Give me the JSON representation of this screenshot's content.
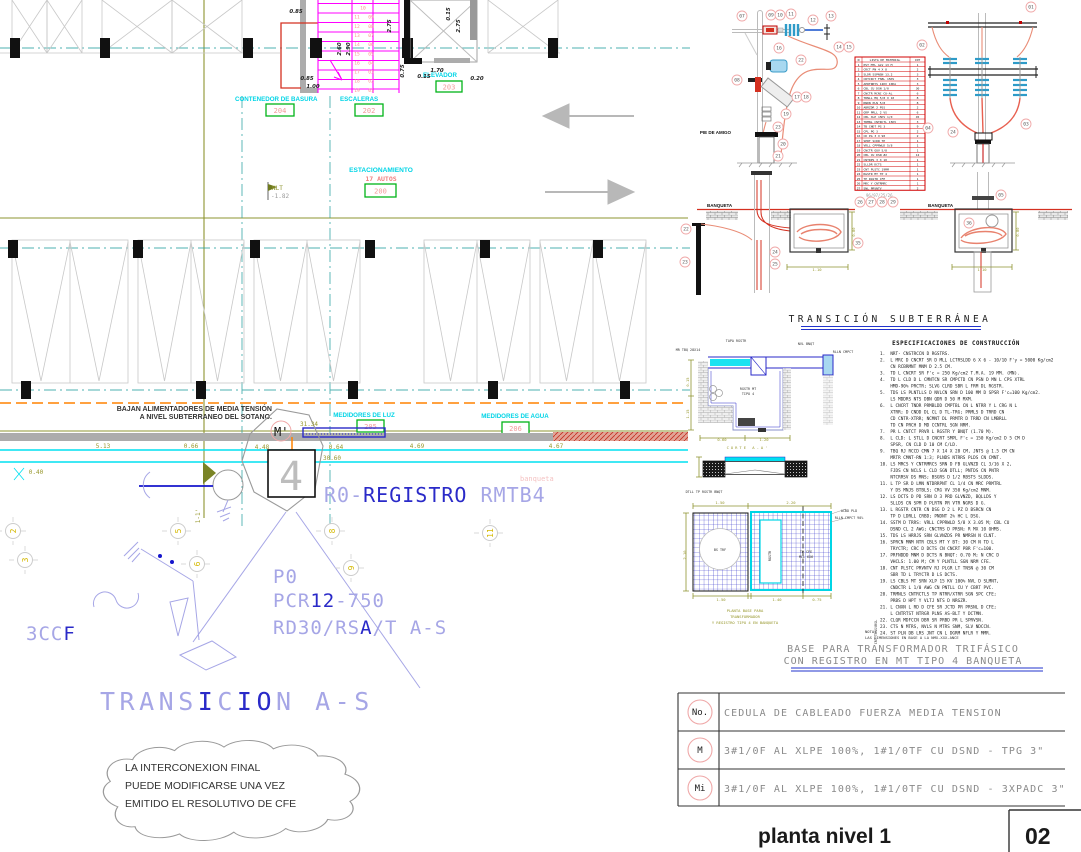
{
  "plan": {
    "labels": {
      "contenedor": "CONTENEDOR DE BASURA",
      "tag_contenedor": "204",
      "escaleras": "ESCALERAS",
      "tag_escaleras": "202",
      "elevador": "ELEVADOR",
      "tag_elevador": "203",
      "estacionamiento": "ESTACIONAMIENTO",
      "autos": "17 AUTOS",
      "tag_estacionamiento": "200",
      "medidores_luz": "MEDIDORES DE LUZ",
      "tag_luz": "205",
      "medidores_agua": "MEDIDORES DE AGUA",
      "tag_agua": "206",
      "nlt": "NLT",
      "nlt_level": "-1.82",
      "banqueta_faint": "banqueta"
    },
    "bajan_line1": "BAJAN ALIMENTADORES DE MEDIA TENSIÓN",
    "bajan_line2": "A NIVEL SUBTERRANEO DEL SOTANO.",
    "marker_m": "M'",
    "section_mark": "1-1'",
    "big_texts": {
      "p0": "P0",
      "reg_a": "R0-",
      "reg_b": "REGISTRO",
      "reg_c": " RMTB4",
      "pcr_a": "PCR",
      "pcr_b": "12",
      "pcr_c": "-750",
      "rd_a": "RD30/RS",
      "rd_b": "A",
      "rd_c": "/T A-S",
      "ccf_a": "3CC",
      "ccf_b": "F",
      "tr_a": "TRANS",
      "tr_b": "I",
      "tr_c": "C",
      "tr_d": "I",
      "tr_e": "O",
      "tr_f": "N A-S"
    },
    "cloud_lines": [
      "LA INTERCONEXION FINAL",
      "PUEDE MODIFICARSE UNA VEZ",
      "EMITIDO EL RESOLUTIVO DE CFE"
    ],
    "stair_steps_left": [
      "10",
      "11",
      "12",
      "13",
      "14",
      "15",
      "16",
      "17",
      "18",
      "19"
    ],
    "stair_steps_right": [
      "",
      "09",
      "08",
      "07",
      "06",
      "05",
      "04",
      "03",
      "02",
      "01"
    ],
    "grid_bubbles": [
      "2",
      "3",
      "5",
      "6",
      "8",
      "9",
      "11"
    ],
    "dims": [
      "0.85",
      "2.60",
      "2.90",
      "0.85",
      "1.00",
      "2.75",
      "2.75",
      "0.75",
      "0.15",
      "1.70",
      "0.20",
      "0.15",
      "5.13",
      "0.66",
      "4.48",
      "0.64",
      "4.69",
      "4.67",
      "30.60",
      "0.40",
      "31.34"
    ]
  },
  "details": {
    "titles": {
      "transicion_sub": "TRANSICIÓN SUBTERRÁNEA",
      "base_line1": "BASE PARA TRANSFORMADOR TRIFÁSICO",
      "base_line2": "CON REGISTRO EN MT TIPO 4 BANQUETA",
      "specs": "ESPECIFICACIONES DE CONSTRUCCIÓN",
      "corte_caption": "CORTE A-A'",
      "base_caption1": "PLANTA BASE PARA",
      "base_caption2": "TRANSFORMADOR",
      "base_caption3": "Y REGISTRO TIPO 4 EN BANQUETA",
      "nota1": "NOTA:",
      "nota2": "LAS DIMENSIONES EN BASE A LA NMX-XXX-ANCE"
    },
    "banqueta1": "BANQUETA",
    "banqueta2": "BANQUETA",
    "pie_de_amigo": "PIE DE AMIGO",
    "ref_numbers": "96/97/25/26",
    "material_header_no": "N",
    "material_header_desc": "LISTA DE MATERIAL",
    "material_header_qty": "CNT",
    "callouts_pole1": [
      "07",
      "09",
      "10",
      "11",
      "12",
      "13",
      "14",
      "15",
      "16",
      "22",
      "08",
      "17",
      "18",
      "19",
      "23",
      "20",
      "21"
    ],
    "callouts_pole2": [
      "01",
      "02",
      "03",
      "24",
      "04"
    ],
    "callouts_underground": [
      "22",
      "23",
      "24",
      "25",
      "26",
      "27",
      "28",
      "29",
      "35",
      "05",
      "36"
    ],
    "material_rows": [
      {
        "d": "PST MTL GLV 13 M",
        "q": "1"
      },
      {
        "d": "CRCT PN 4 X 8",
        "q": "2"
      },
      {
        "d": "SLDR SSPNSN 13.2",
        "q": "3"
      },
      {
        "d": "CRTCRCT FSBL 15KV",
        "q": "3"
      },
      {
        "d": "APRTRRYS 12KV 10KA",
        "q": "3"
      },
      {
        "d": "CBL CU DSN 1/0",
        "q": "30"
      },
      {
        "d": "CNCTR MCNC CU-AL",
        "q": "6"
      },
      {
        "d": "TRNLL MQ 5/8 X 10",
        "q": "8"
      },
      {
        "d": "RNDN PLN 5/8",
        "q": "8"
      },
      {
        "d": "ABRZDR 2 PSS",
        "q": "2"
      },
      {
        "d": "GRP PRLL 2 VS",
        "q": "6"
      },
      {
        "d": "CBL XLP 15KV 1/0",
        "q": "45"
      },
      {
        "d": "TRMNL CNTRCTL 15KV",
        "q": "3"
      },
      {
        "d": "TB CNDT PG 3",
        "q": "9"
      },
      {
        "d": "CPL PG 3",
        "q": "2"
      },
      {
        "d": "CD PG 3 X 90",
        "q": "2"
      },
      {
        "d": "SPRT SCDR TP",
        "q": "1"
      },
      {
        "d": "VRLL CPPRWLD 5/8",
        "q": "1"
      },
      {
        "d": "CNCTR GUV 5/8",
        "q": "1"
      },
      {
        "d": "CBL CU DSN #2",
        "q": "12"
      },
      {
        "d": "CNTRPS 3 X 10",
        "q": "1"
      },
      {
        "d": "SLLDR DCTS",
        "q": "1"
      },
      {
        "d": "CNT PLSTC 19MM",
        "q": "1"
      },
      {
        "d": "RGSTR MT TP 4",
        "q": "1"
      },
      {
        "d": "TP RGSTR CFE",
        "q": "1"
      },
      {
        "d": "MRC Y CNTRMRC",
        "q": "1"
      },
      {
        "d": "SNL PRVNTV",
        "q": "2"
      }
    ],
    "spec_lines": [
      "1.  NRT- CNSTRCCN D RGSTRS.",
      "2.  L MRC D CNCRT SR D MLL LCTRSLDD 6 X 6 - 10/10 F'y = 5000 Kg/cm2",
      "    CN RCBRMNT MNM D 2.5 CM.",
      "3.  TD L CNCRT SR F'c = 250 Kg/cm2 T.M.A. 19 MM. (MN).",
      "4.  TD L CLD D L CMNTCN SR CMPCTD CN PSN D MN L CPS XTRL",
      "    HMD-90% PRCTR; SLVG CLRD SBR L FRM DL RGSTR.",
      "5.  TDS LS PLNTLLS D NVLCN SRN D 100 MM D SPSR F'c=100 Kg/cm2.",
      "    LS MDDRS NTS DBN QDR D 50 M MXM.",
      "6.  L CNCRT TNDR PRMBLDD CMPTBL CN L NTRR Y L CRG N L",
      "    XTRR; D CNDD DL CL D TL-TRG; PRMLS D TRRD CN",
      "    CD CNTR-XTRR; NCMNT DL PRMTR D TRRD CN LMBRLL",
      "    TD CN PRCH D MD CCNTRL SGN NRM.",
      "7.  PR L CNTCT PRVR L RGSTR Y BNQT (1.70 M).",
      "8.  L CLD: L STLL D CNCRT SMPL F'c = 150 Kg/cm2 D 5 CM D",
      "    SPSR, CN CLD D 10 CM C/LD.",
      "9.  TBQ RJ RCCD CMN 7 X 14 X 28 CM, JNTS @ 1.5 CM CN",
      "    MRTR CMNT-RN 1:3; PLNDS NTRRS PLDS CN CMNT.",
      "10. LS MRCS Y CNTRMRCS SRN D FB GLVNZD CL 3/16 X 2,",
      "    FJDS CN NCLS L CLD SGN DTLL; PNTDS CN PNTR",
      "    NTCRRSV DS MNS; BSGRS D 1/2 RBSTS SLDDS.",
      "11. L TP SR D LMN NTDRRPNT CL 1/4 CN MRC PRMTRL",
      "    Y DS MNJS BTBLS; CRG VV 350 Kg/cm2 MNM.",
      "12. LS DCTS D PD SRN D 3 PRD GLVNZD, BQLLDS Y",
      "    SLLDS CN SPM D PLRTN PR VTR NGRS D G.",
      "13. L RGSTR CNTR CN DSG D 2 L PZ D BSRCN CN",
      "    TP D LDRLL CRBD; PNDNT 2% HC L DSG.",
      "14. SSTM D TRRS: VRLL CPPRWLD 5/8 X 3.05 M; CBL CU",
      "    DSND CL 2 AWG; CNCTRS D PRSN; R MX 10 OHMS.",
      "15. TDS LS HRRJS SRN GLVNZDS PR NMRSN N CLNT.",
      "16. SPRCN MNM NTR CBLS MT Y BT: 30 CM N TD L",
      "    TRYCTR; CRC D DCTS CN CNCRT PBR F'c=100.",
      "17. PRFNDDD MNM D DCTS N BNQT: 0.70 M; N CRC D",
      "    VHCLS: 1.00 M; CM Y PLNTLL SGN NRM CFE.",
      "18. CNT PLSTC PRVNTV RJ PLGR LT TNSN @ 30 CM",
      "    SBR TD L TRYCTR D LS DCTS.",
      "19. LS CBLS MT SRN XLP 15 KV 100% NVL D SLMNT,",
      "    CNDCTR L 1/0 AWG CN PNTLL CU Y CBRT PVC.",
      "20. TRMNLS CNTRCTLS TP NTRR/XTRR SGN SPC CFE;",
      "    PRBS D HPT Y VLTJ NTS D NRGZR.",
      "21. L CNXN L RD D CFE SR JCTD PR PRSNL D CFE;",
      "    L CNTRTST NTRGR PLNS AS-BLT Y DCTMN.",
      "22. CLQR MDFCCN DBR SR PRBD PR L SPRVSN.",
      "23. CTS N MTRS, NVLS N MTRS SNM, SLV NDCCN.",
      "24. ST PLN DB LRS JNT CN L DGRM NFLR Y MMR."
    ],
    "micro": [
      "TAPA RGSTR",
      "NVL BNQT",
      "RLLN CMPCT",
      "MR TBQ 28X14",
      "RGSTR MT",
      "TIPO 4",
      "0.15",
      "1.15",
      "0.60",
      "1.20",
      "DTLL TP RGSTR BNQT",
      "1.50",
      "2.20",
      "1.50",
      "1.40",
      "0.75",
      "2.10",
      "BS TRF",
      "RGSTR",
      "TP CFE",
      "MLL 6X6",
      "ACBD PLD",
      "RLLN CMPCT 90%",
      "CRT TRNSVRSL",
      "1.10",
      "1.10",
      "0.80",
      "0.80"
    ]
  },
  "cable_table": {
    "rows": [
      {
        "key": "No.",
        "text": "CEDULA DE CABLEADO FUERZA MEDIA TENSION"
      },
      {
        "key": "M",
        "text": "3#1/0F AL XLPE 100%, 1#1/0TF CU DSND - TPG 3\""
      },
      {
        "key": "Mi",
        "text": "3#1/0F AL XLPE 100%, 1#1/0TF CU DSND - 3XPADC 3\""
      }
    ]
  },
  "titleblock": {
    "title": "planta nivel 1",
    "number": "02"
  }
}
